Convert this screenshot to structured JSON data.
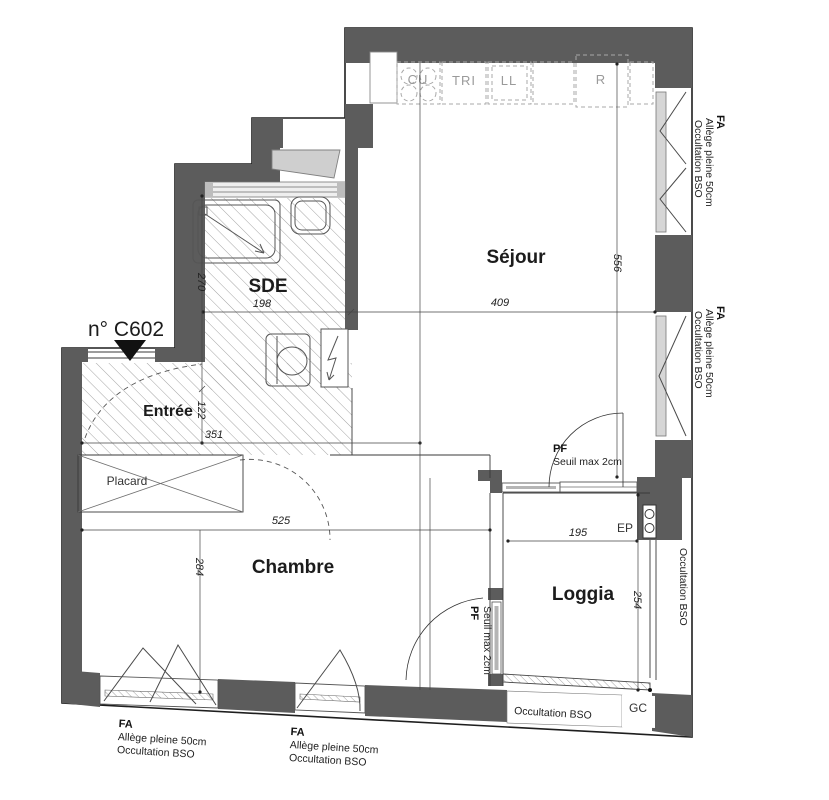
{
  "unit": {
    "number": "n° C602"
  },
  "rooms": {
    "sejour": "Séjour",
    "sde": "SDE",
    "entree": "Entrée",
    "chambre": "Chambre",
    "loggia": "Loggia",
    "placard": "Placard"
  },
  "kitchen": {
    "cu": "CU",
    "tri": "TRI",
    "ll": "LL",
    "r": "R"
  },
  "dimensions": {
    "d409": "409",
    "d556": "556",
    "d198": "198",
    "d270": "270",
    "d122": "122",
    "d351": "351",
    "d525": "525",
    "d284": "284",
    "d195": "195",
    "d254": "254"
  },
  "doors": {
    "pf_sejour": {
      "label": "PF",
      "note": "Seuil max  2cm"
    },
    "pf_chambre": {
      "label": "PF",
      "note": "Seuil max  2cm"
    }
  },
  "windows": {
    "fa_right_top": {
      "title": "FA",
      "allege": "Allège pleine  50cm",
      "occultation": "Occultation   BSO"
    },
    "fa_right_mid": {
      "title": "FA",
      "allege": "Allège pleine  50cm",
      "occultation": "Occultation   BSO"
    },
    "fa_bottom_left": {
      "title": "FA",
      "allege": "Allège pleine  50cm",
      "occultation": "Occultation     BSO"
    },
    "fa_bottom_mid": {
      "title": "FA",
      "allege": "Allège pleine  50cm",
      "occultation": "Occultation    BSO"
    }
  },
  "loggia_annotations": {
    "occultation_side": "Occultation  BSO",
    "occultation_bottom": "Occultation BSO",
    "ep": "EP",
    "gc": "GC"
  },
  "colors": {
    "wall": "#5c5c5c",
    "line": "#2a2a2a",
    "glass": "#d6d6d6",
    "hatch": "#9a9a9a",
    "dash": "#aaaaaa"
  }
}
